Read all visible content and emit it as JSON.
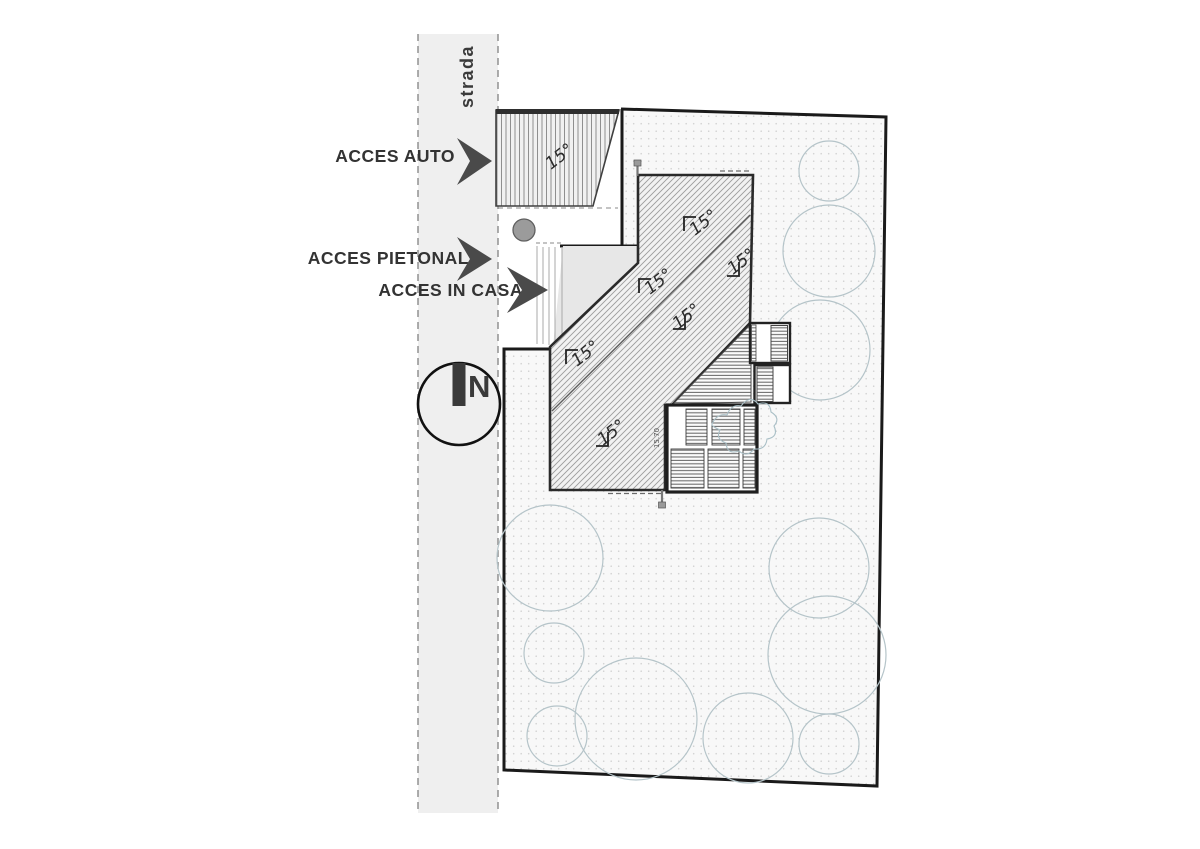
{
  "road": {
    "label": "strada"
  },
  "access": {
    "auto": "ACCES AUTO",
    "pietonal": "ACCES PIETONAL",
    "casa": "ACCES IN CASA"
  },
  "north": {
    "label": "N"
  },
  "slopes": {
    "garage": "15°",
    "roof": [
      "15°",
      "15°",
      "15°",
      "15°",
      "15°",
      "15°"
    ]
  },
  "dimensions": {
    "house_side": "15.70"
  },
  "colors": {
    "boundary": "#1a1a1a",
    "road_fill": "#efefef",
    "site_fill": "#f8f8f8",
    "tree_outline": "#b5c4c9",
    "arrow": "#4a4a4a",
    "label_text": "#333333",
    "roof_outline": "#2a2a2a"
  }
}
